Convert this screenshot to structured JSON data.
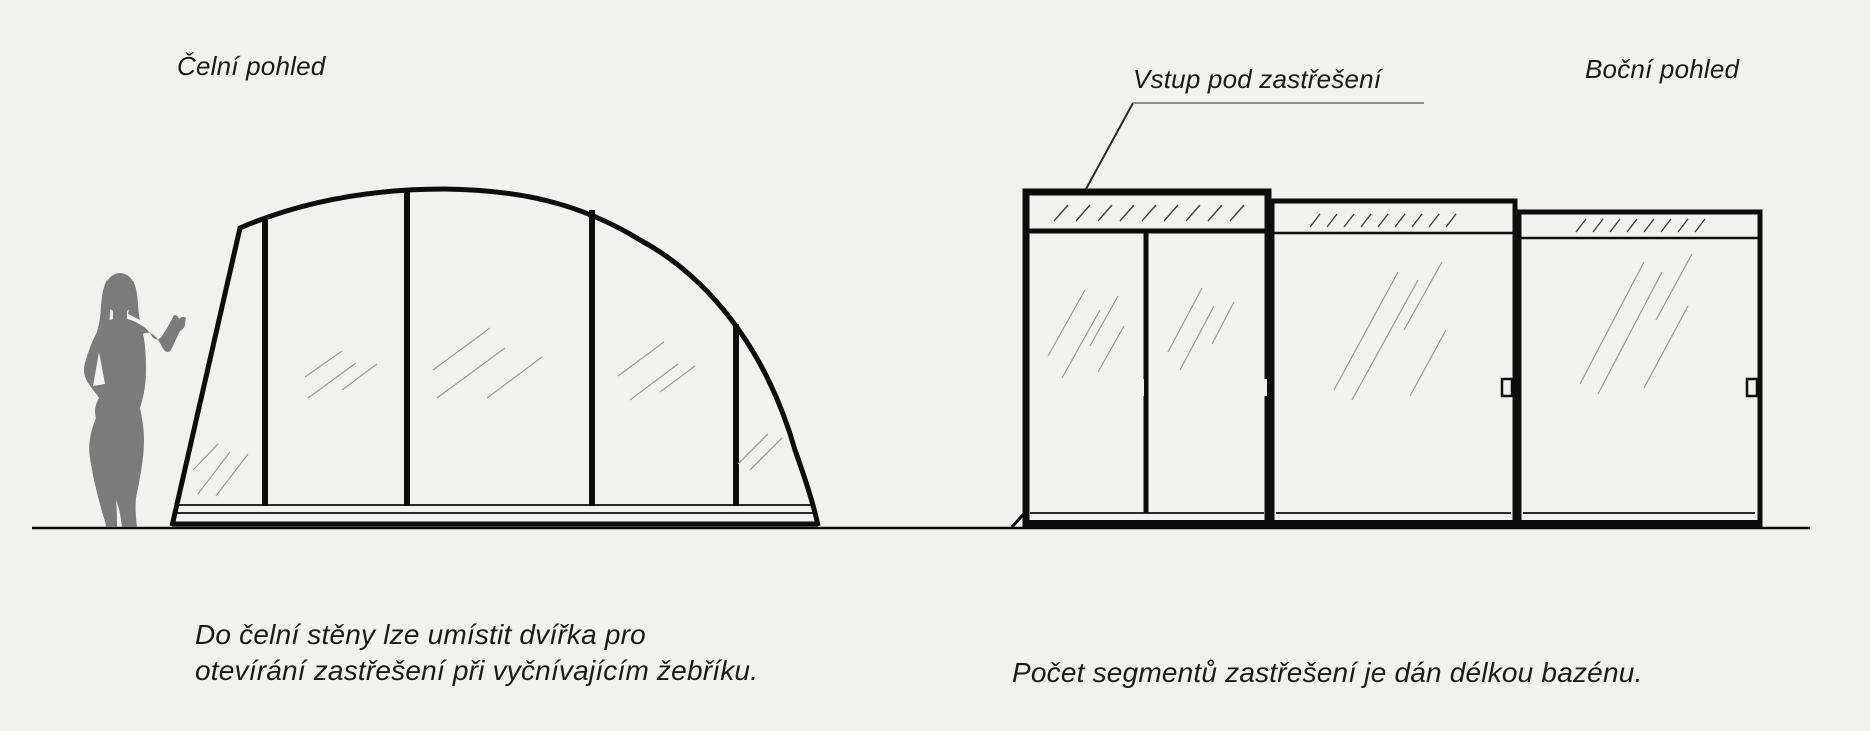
{
  "front_view": {
    "title": "Čelní pohled",
    "note_line1": "Do čelní stěny lze umístit dvířka pro",
    "note_line2": "otevírání zastřešení při vyčnívajícím žebříku."
  },
  "side_view": {
    "title": "Boční pohled",
    "entry_label": "Vstup pod zastřešení",
    "note": "Počet segmentů zastřešení je dán délkou bazénu.",
    "segment_count": 3
  },
  "colors": {
    "background": "#f1f1ef",
    "line": "#0d0d0d",
    "person": "#7b7b7b",
    "shine": "#9a9a9a",
    "underline": "#8d8d8d",
    "text": "#1a1a1a"
  }
}
